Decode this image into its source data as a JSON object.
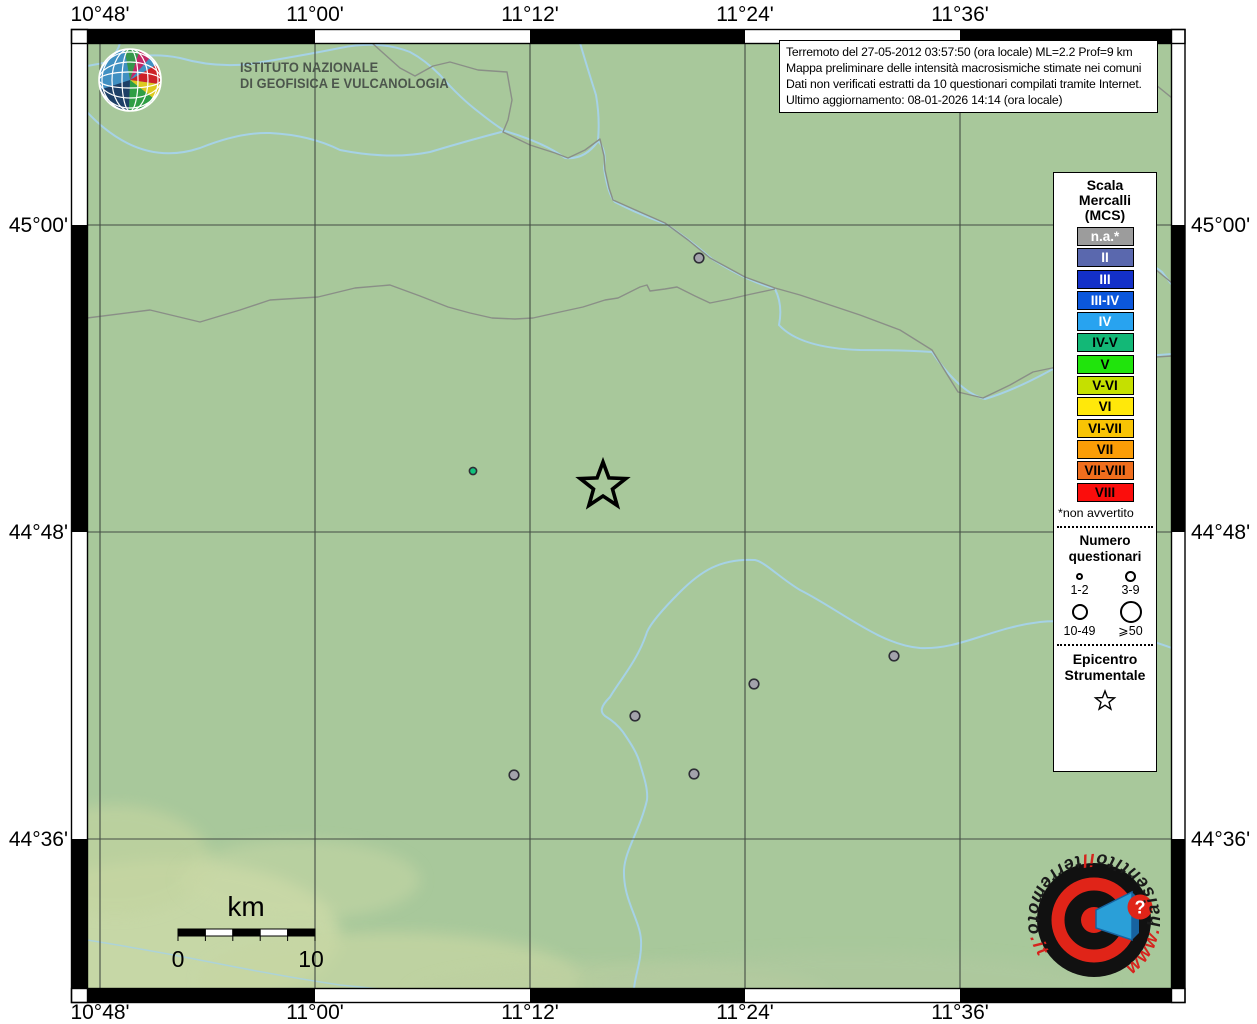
{
  "axis": {
    "lon": [
      {
        "label": "10°48'",
        "x": 100
      },
      {
        "label": "11°00'",
        "x": 315
      },
      {
        "label": "11°12'",
        "x": 530
      },
      {
        "label": "11°24'",
        "x": 745
      },
      {
        "label": "11°36'",
        "x": 960
      }
    ],
    "lat": [
      {
        "label": "45°00'",
        "y": 225
      },
      {
        "label": "44°48'",
        "y": 532
      },
      {
        "label": "44°36'",
        "y": 839
      }
    ]
  },
  "header": {
    "ingv_line1": "ISTITUTO NAZIONALE",
    "ingv_line2": "DI GEOFISICA E VULCANOLOGIA"
  },
  "info_box": {
    "line1": "Terremoto del 27-05-2012 03:57:50 (ora locale) ML=2.2 Prof=9 km",
    "line2": "Mappa preliminare delle intensità macrosismiche stimate nei comuni",
    "line3": "Dati non verificati estratti da 10 questionari compilati tramite Internet.",
    "line4": "Ultimo aggiornamento: 08-01-2026 14:14 (ora locale)"
  },
  "legend": {
    "title1": "Scala",
    "title2": "Mercalli",
    "title3": "(MCS)",
    "scale": [
      {
        "label": "n.a.*",
        "color": "#9c9c9c",
        "text": "#ffffff"
      },
      {
        "label": "II",
        "color": "#5a68ae",
        "text": "#ffffff"
      },
      {
        "label": "III",
        "color": "#1330c8",
        "text": "#ffffff"
      },
      {
        "label": "III-IV",
        "color": "#0b57dc",
        "text": "#ffffff"
      },
      {
        "label": "IV",
        "color": "#28a3f0",
        "text": "#ffffff"
      },
      {
        "label": "IV-V",
        "color": "#13b877",
        "text": "#000000"
      },
      {
        "label": "V",
        "color": "#20e40c",
        "text": "#000000"
      },
      {
        "label": "V-VI",
        "color": "#c5e000",
        "text": "#000000"
      },
      {
        "label": "VI",
        "color": "#ffe80a",
        "text": "#000000"
      },
      {
        "label": "VI-VII",
        "color": "#f8c404",
        "text": "#000000"
      },
      {
        "label": "VII",
        "color": "#fb9d06",
        "text": "#000000"
      },
      {
        "label": "VII-VIII",
        "color": "#f06e1d",
        "text": "#000000"
      },
      {
        "label": "VIII",
        "color": "#fb0d0c",
        "text": "#000000"
      }
    ],
    "footnote": "*non avvertito",
    "questionnaires": {
      "title1": "Numero",
      "title2": "questionari",
      "sizes": [
        {
          "label": "1-2",
          "d": 7
        },
        {
          "label": "3-9",
          "d": 11
        },
        {
          "label": "10-49",
          "d": 16
        },
        {
          "label": "⩾50",
          "d": 22
        }
      ]
    },
    "epicenter_title1": "Epicentro",
    "epicenter_title2": "Strumentale"
  },
  "scalebar": {
    "unit": "km",
    "start": "0",
    "end": "10"
  },
  "site_logo": {
    "www": "www.",
    "prefix": "haisentito",
    "il": "il",
    "main": "terremoto",
    "tld": ".it",
    "question": "?"
  },
  "map": {
    "bg_color": "#a8c89b",
    "river_color": "#a6d2e6",
    "boundary_color": "#8a8f87",
    "epicenter": {
      "x": 603,
      "y": 486
    },
    "point_colors": {
      "n.a.": "#a3a3ab",
      "IV-V": "#10c27c"
    },
    "points": [
      {
        "x": 699,
        "y": 258,
        "intensity": "n.a.",
        "r": 4.8
      },
      {
        "x": 894,
        "y": 656,
        "intensity": "n.a.",
        "r": 4.8
      },
      {
        "x": 754,
        "y": 684,
        "intensity": "n.a.",
        "r": 4.8
      },
      {
        "x": 635,
        "y": 716,
        "intensity": "n.a.",
        "r": 4.8
      },
      {
        "x": 514,
        "y": 775,
        "intensity": "n.a.",
        "r": 4.8
      },
      {
        "x": 694,
        "y": 774,
        "intensity": "n.a.",
        "r": 4.8
      },
      {
        "x": 473,
        "y": 471,
        "intensity": "IV-V",
        "r": 3.6
      }
    ]
  }
}
